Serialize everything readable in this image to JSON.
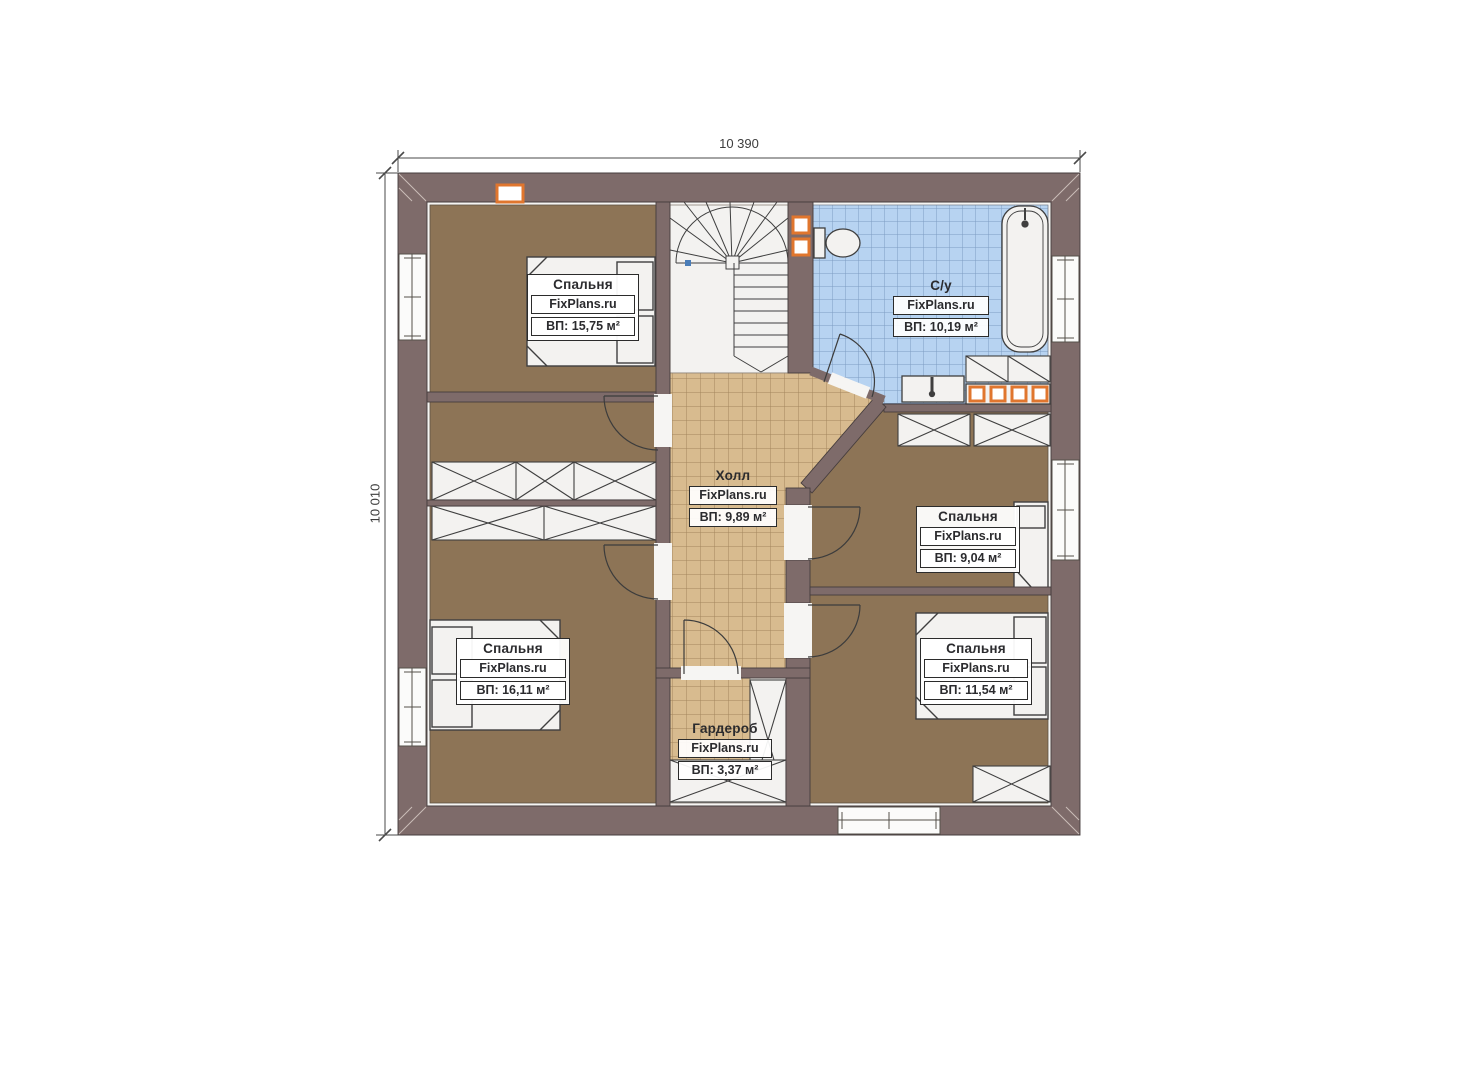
{
  "plan": {
    "type": "floor-plan",
    "floor_description": "second floor plan with four bedrooms, bathroom, hall, wardrobe and winder staircase"
  },
  "dimensions": {
    "width_label": "10 390",
    "height_label": "10 010"
  },
  "rooms": [
    {
      "id": "bedroom-top-left",
      "label": "Спальня",
      "brand": "FixPlans.ru",
      "area": "ВП: 15,75 м²"
    },
    {
      "id": "bathroom",
      "label": "С/у",
      "brand": "FixPlans.ru",
      "area": "ВП: 10,19 м²"
    },
    {
      "id": "hall",
      "label": "Холл",
      "brand": "FixPlans.ru",
      "area": "ВП: 9,89 м²"
    },
    {
      "id": "bedroom-middle-right",
      "label": "Спальня",
      "brand": "FixPlans.ru",
      "area": "ВП: 9,04 м²"
    },
    {
      "id": "bedroom-bottom-left",
      "label": "Спальня",
      "brand": "FixPlans.ru",
      "area": "ВП: 16,11 м²"
    },
    {
      "id": "bedroom-bottom-right",
      "label": "Спальня",
      "brand": "FixPlans.ru",
      "area": "ВП: 11,54 м²"
    },
    {
      "id": "wardrobe",
      "label": "Гардероб",
      "brand": "FixPlans.ru",
      "area": "ВП: 3,37 м²"
    }
  ],
  "colors": {
    "wall": "#7e6b6a",
    "bedroom_floor": "#8d7456",
    "hall_floor": "#d8bb8f",
    "bathroom_floor": "#b7d3f1",
    "accent_orange": "#e0762e",
    "fixture_white": "#f3f2f0",
    "line_dark": "#3f3f3f"
  }
}
